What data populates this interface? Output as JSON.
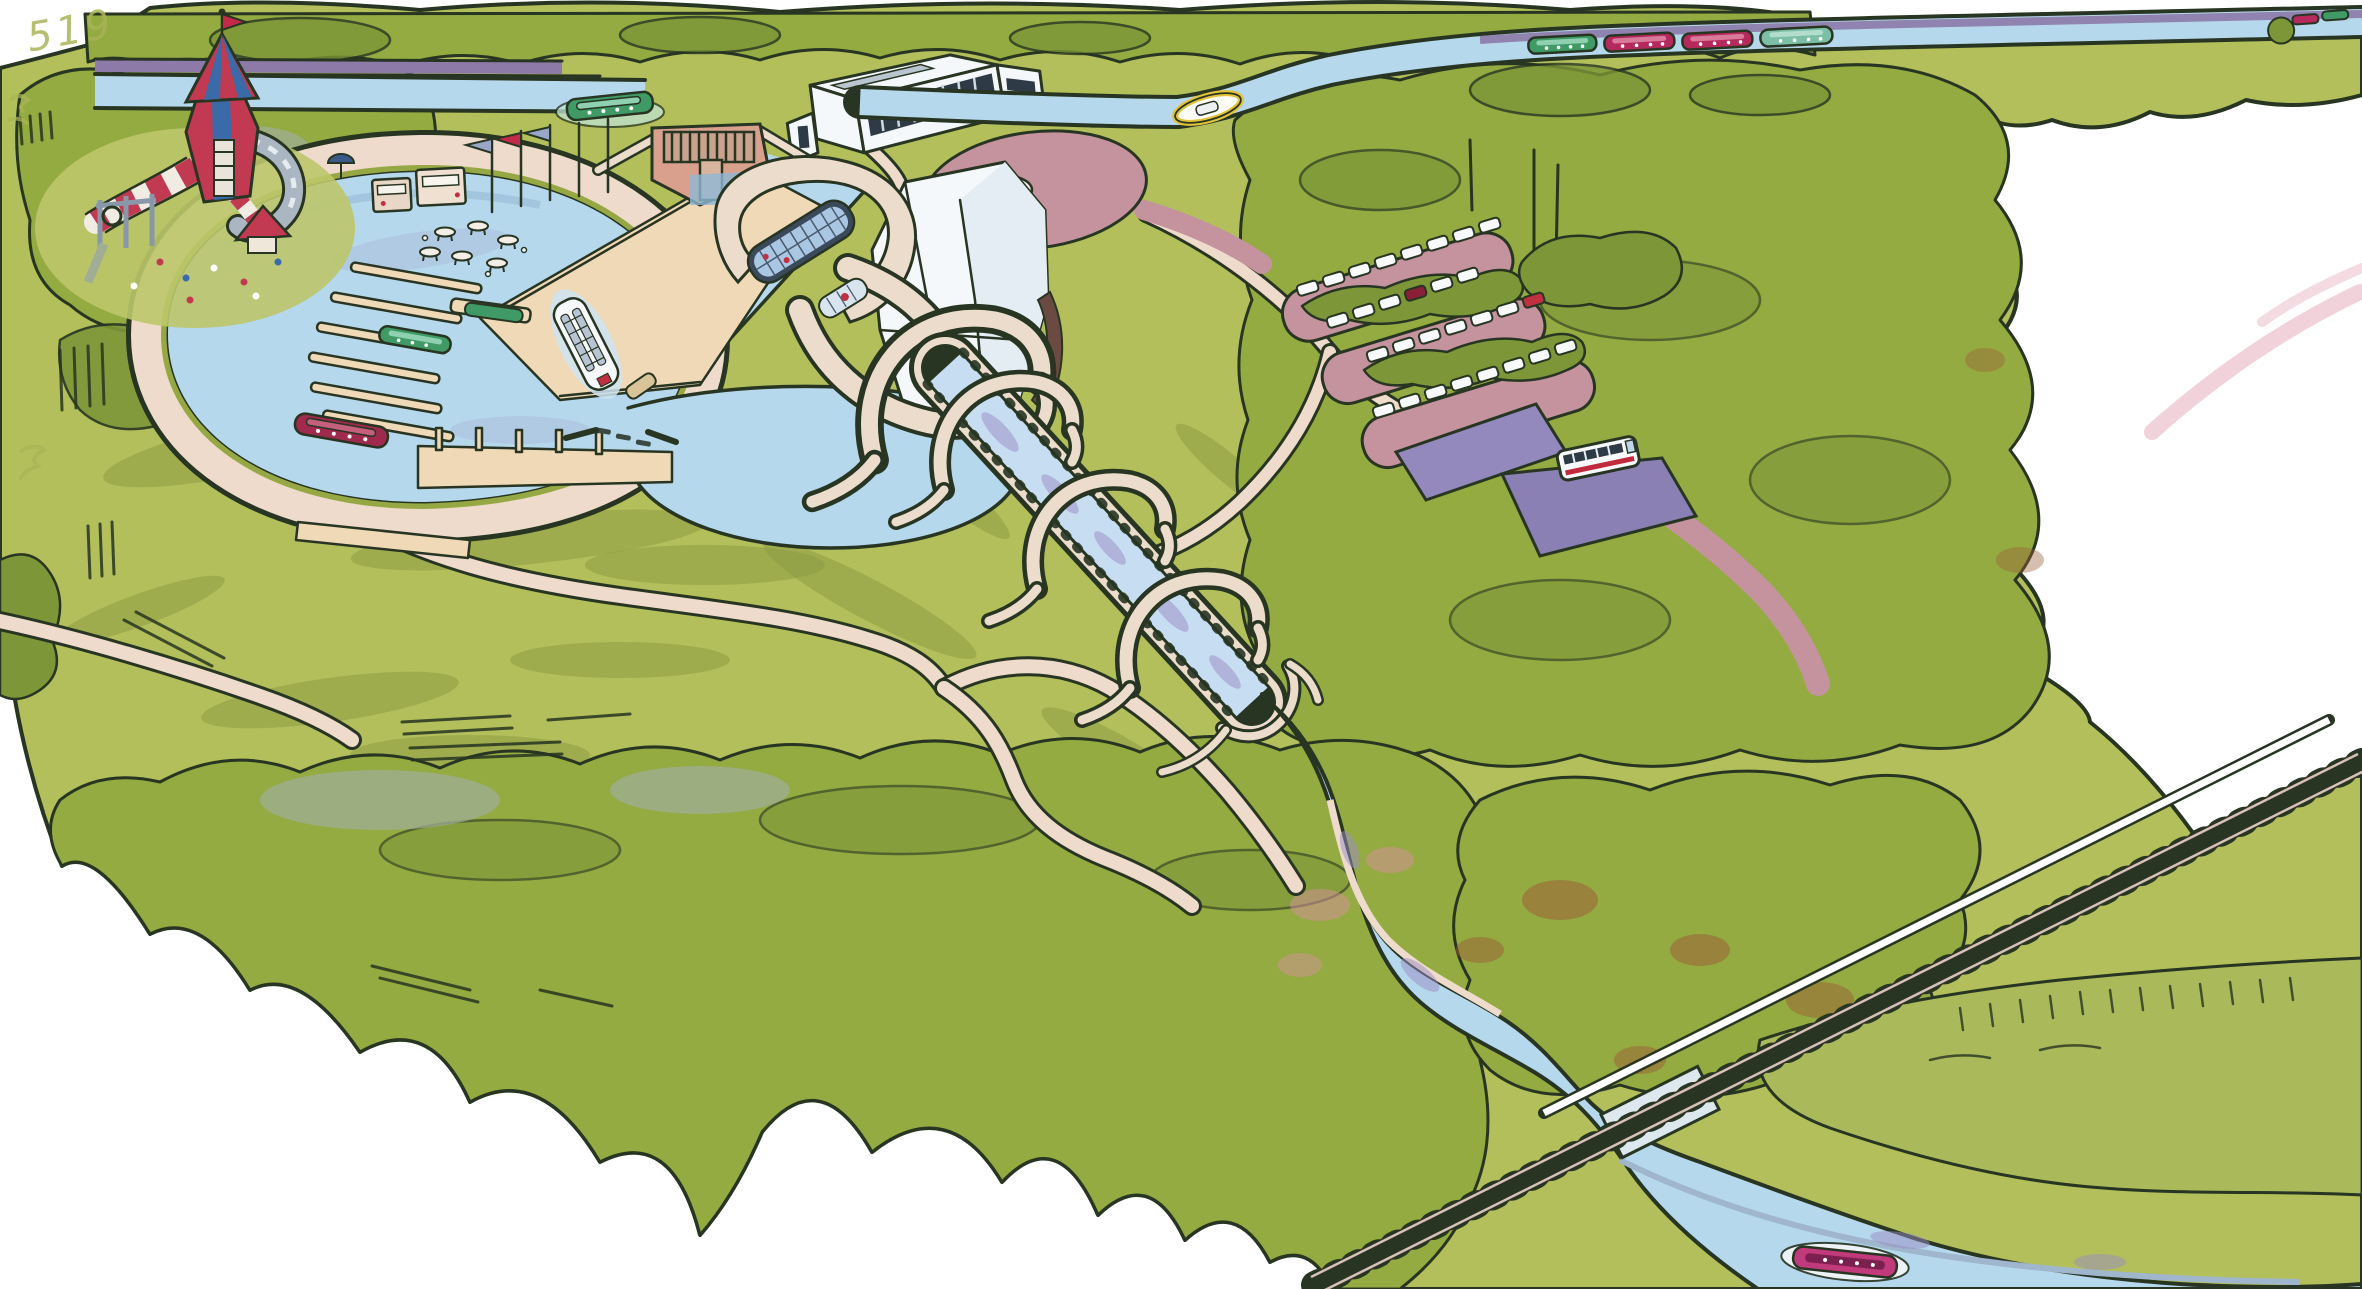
{
  "annotations": {
    "handwriting": "519"
  },
  "palette": {
    "bg": "#ffffff",
    "ink": "#273522",
    "grass": "#b2bf5b",
    "grass_light": "#c3cd72",
    "grass_shade": "#8a9a42",
    "tree": "#94ab41",
    "tree_dark": "#7d9638",
    "tree_gray": "#9fae95",
    "water": "#b6d8ec",
    "water_light": "#cde3f4",
    "lavender": "#9b8cc4",
    "towpath": "#8d7aa8",
    "path": "#eedbcb",
    "pier": "#f0d9b6",
    "pier_edge": "#d9ad82",
    "parking": "#c4939e",
    "lot_purple": "#9389bd",
    "road_pink": "#d8a2aa",
    "rail": "#8a5046",
    "cream": "#ecdccb",
    "panel": "#f5f8fa",
    "glass": "#a9c6e2",
    "frame": "#3a4a5a",
    "boat_green": "#3f9a66",
    "boat_teal": "#7bbfa6",
    "boat_crimson": "#b5295d",
    "boat_maroon": "#a02a4e",
    "boat_magenta": "#c03a7c",
    "boat_yellow": "#e2c238",
    "flag_red": "#c32a4a",
    "flag_lavender": "#9aa6c8",
    "play_red": "#c13a52",
    "play_blue": "#3a6aa8",
    "slide_gray": "#aab6c2",
    "autumn": "#9a6038",
    "blossom": "#d890a0",
    "shore_blue": "#9fb6cc",
    "marsh": "#aab95a"
  },
  "features": [
    {
      "name": "playground-castle",
      "label": "playground with striped castle tower and tube slides"
    },
    {
      "name": "upper-canal",
      "label": "canal with purple towpath"
    },
    {
      "name": "canal-lock",
      "label": "lock gates with comb weir"
    },
    {
      "name": "flag-poles",
      "label": "flag poles",
      "count": 5,
      "flag_colors": [
        "#9aa6c8",
        "#c32a4a",
        "#9aa6c8"
      ]
    },
    {
      "name": "ticket-kiosks",
      "label": "small kiosks",
      "count": 2
    },
    {
      "name": "picnic-tables",
      "label": "picnic tables",
      "count": 6
    },
    {
      "name": "marina-basin",
      "label": "oval marina basin with wide promenade"
    },
    {
      "name": "jetty-fingers",
      "label": "floating finger jetties",
      "count": 6
    },
    {
      "name": "boat-lift",
      "label": "rotating boat lift with glass gondolas"
    },
    {
      "name": "visitor-centre",
      "label": "white visitor centre with glazed front"
    },
    {
      "name": "roundabout",
      "label": "circular mauve plaza"
    },
    {
      "name": "aqueduct",
      "label": "elevated aqueduct with hooped arches",
      "arches": 3
    },
    {
      "name": "car-park",
      "label": "tree-lined car park",
      "cars": 29,
      "red_cars": 1,
      "dark_red_cars": 1
    },
    {
      "name": "overflow-car-park",
      "label": "purple surfaced lots",
      "count": 2
    },
    {
      "name": "bus",
      "label": "white bus with red stripe"
    },
    {
      "name": "railway",
      "label": "railway line crossing the canal on a bridge"
    },
    {
      "name": "lower-canal",
      "label": "canal descending to pool and railway bridge"
    },
    {
      "name": "forest",
      "label": "dense tree masses with autumn patches"
    },
    {
      "name": "marsh",
      "label": "reed bank with tufts beside lower canal"
    }
  ],
  "boats": {
    "marina": [
      {
        "type": "narrowboat",
        "color": "#3f9a66"
      },
      {
        "type": "narrowboat",
        "color": "#a02a4e"
      },
      {
        "type": "tour-boat",
        "color": "#f6f8fa"
      },
      {
        "type": "dinghy",
        "color": "#d9c49a"
      }
    ],
    "upper_canal": [
      {
        "type": "narrowboat",
        "color": "#3f9a66"
      },
      {
        "type": "small-boat",
        "color": "#e2c238"
      }
    ],
    "moored_row": [
      {
        "color": "#3f9a66"
      },
      {
        "color": "#b5295d"
      },
      {
        "color": "#b5295d"
      },
      {
        "color": "#7bbfa6"
      }
    ],
    "lower_canal": [
      {
        "type": "narrowboat",
        "color": "#c03a7c"
      }
    ]
  }
}
